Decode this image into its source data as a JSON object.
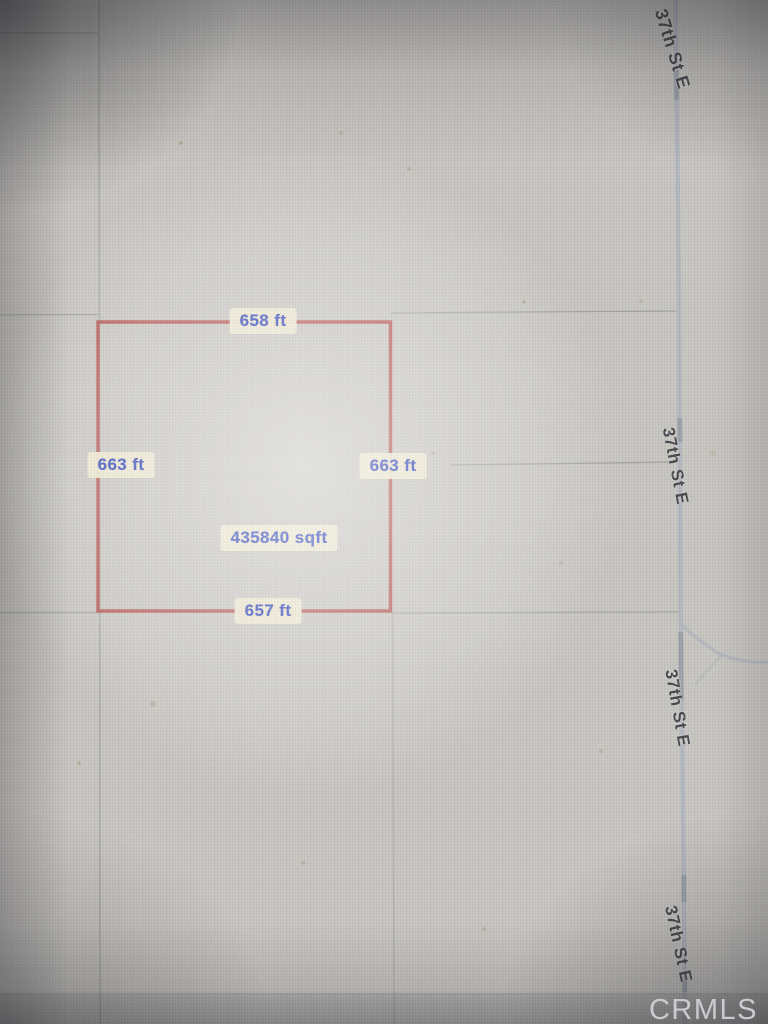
{
  "parcel": {
    "top_length": "658 ft",
    "left_length": "663 ft",
    "right_length": "663 ft",
    "bottom_length": "657 ft",
    "area": "435840 sqft",
    "outline_color": "#b65550",
    "label_bg_color": "#ede7cf",
    "label_text_color": "#3348b8"
  },
  "road": {
    "name": "37th St E",
    "label_instances": [
      "37th St E",
      "37th St E",
      "37th St E",
      "37th St E"
    ],
    "color": "#b3b7bf"
  },
  "watermark": {
    "text": "CRMLS",
    "color": "#cdd0d5"
  }
}
